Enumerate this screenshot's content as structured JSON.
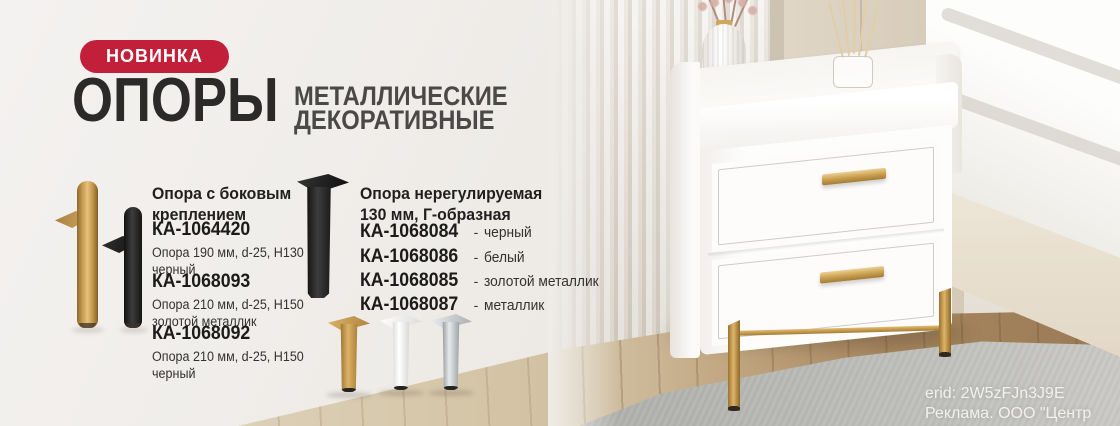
{
  "banner": {
    "badge": "НОВИНКА",
    "title": "ОПОРЫ",
    "subtitle": [
      "МЕТАЛЛИЧЕСКИЕ",
      "ДЕКОРАТИВНЫЕ"
    ]
  },
  "product_groups": [
    {
      "heading": "Опора с боковым креплением",
      "items": [
        {
          "code": "КА-1064420",
          "desc": "Опора 190 мм, d-25, H130 черный"
        },
        {
          "code": "КА-1068093",
          "desc": "Опора 210 мм, d-25, H150 золотой металлик"
        },
        {
          "code": "КА-1068092",
          "desc": "Опора 210 мм, d-25, H150 черный"
        }
      ]
    },
    {
      "heading": "Опора нерегулируемая 130 мм, Г-образная",
      "separator": "-",
      "items": [
        {
          "code": "КА-1068084",
          "color": "черный"
        },
        {
          "code": "КА-1068086",
          "color": "белый"
        },
        {
          "code": "КА-1068085",
          "color": "золотой металлик"
        },
        {
          "code": "КА-1068087",
          "color": "металлик"
        }
      ]
    }
  ],
  "legal": {
    "erid": "erid: 2W5zFJn3J9E",
    "advertiser": "Реклама. ООО \"Центр КДМ\""
  },
  "colors": {
    "badge_bg": "#c2203a",
    "title": "#2b2a28",
    "text": "#34322f",
    "accent_gold": "#c79a4e"
  }
}
